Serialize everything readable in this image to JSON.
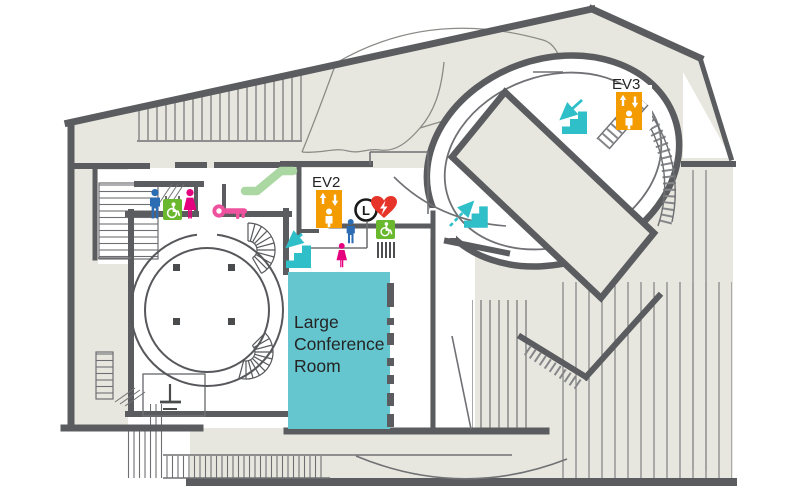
{
  "map": {
    "title": "Facility floor map",
    "labels": {
      "ev2": "EV2",
      "ev3": "EV3",
      "locker": "L"
    },
    "room": {
      "name": "Large Conference Room",
      "lines": [
        "Large",
        "Conference",
        "Room"
      ]
    },
    "icons": [
      {
        "id": "ev2",
        "name": "elevator-icon",
        "label": "EV2",
        "color": "#f49b00"
      },
      {
        "id": "ev3",
        "name": "elevator-icon",
        "label": "EV3",
        "color": "#f49b00"
      },
      {
        "id": "escalator-upper-left",
        "name": "escalator-icon",
        "color": "#abd7a3"
      },
      {
        "id": "stairs-down-central",
        "name": "stairs-down-icon",
        "color": "#2ebfc9"
      },
      {
        "id": "stairs-down-oval-north",
        "name": "stairs-down-icon",
        "color": "#2ebfc9"
      },
      {
        "id": "stairs-up-oval-south",
        "name": "stairs-up-icon",
        "color": "#2ebfc9"
      },
      {
        "id": "restroom-men-west",
        "name": "men-restroom-icon",
        "color": "#2b6cb3"
      },
      {
        "id": "accessible-west",
        "name": "wheelchair-accessible-icon",
        "color": "#6ab82e"
      },
      {
        "id": "restroom-women-west",
        "name": "women-restroom-icon",
        "color": "#e5027e"
      },
      {
        "id": "restroom-men-central",
        "name": "men-restroom-icon",
        "color": "#2b6cb3"
      },
      {
        "id": "restroom-women-central",
        "name": "women-restroom-icon",
        "color": "#e5027e"
      },
      {
        "id": "accessible-central",
        "name": "wheelchair-accessible-icon",
        "color": "#6ab82e"
      },
      {
        "id": "key-room",
        "name": "key-icon",
        "color": "#ee519d"
      },
      {
        "id": "coin-locker",
        "name": "locker-icon",
        "label": "L",
        "color": "#1a1a1a"
      },
      {
        "id": "aed",
        "name": "aed-heart-icon",
        "color": "#e73429"
      }
    ],
    "colors": {
      "wall": "#5b5c5f",
      "floor_beige": "#e8e7df",
      "room_teal": "#66c6cf",
      "icon_teal": "#2ebfc9",
      "orange": "#f49b00",
      "light_green": "#abd7a3",
      "green": "#6ab82e",
      "blue": "#2b6cb3",
      "pink": "#e5027e",
      "key_pink": "#ee519d",
      "red": "#e73429",
      "text": "#242424"
    }
  }
}
